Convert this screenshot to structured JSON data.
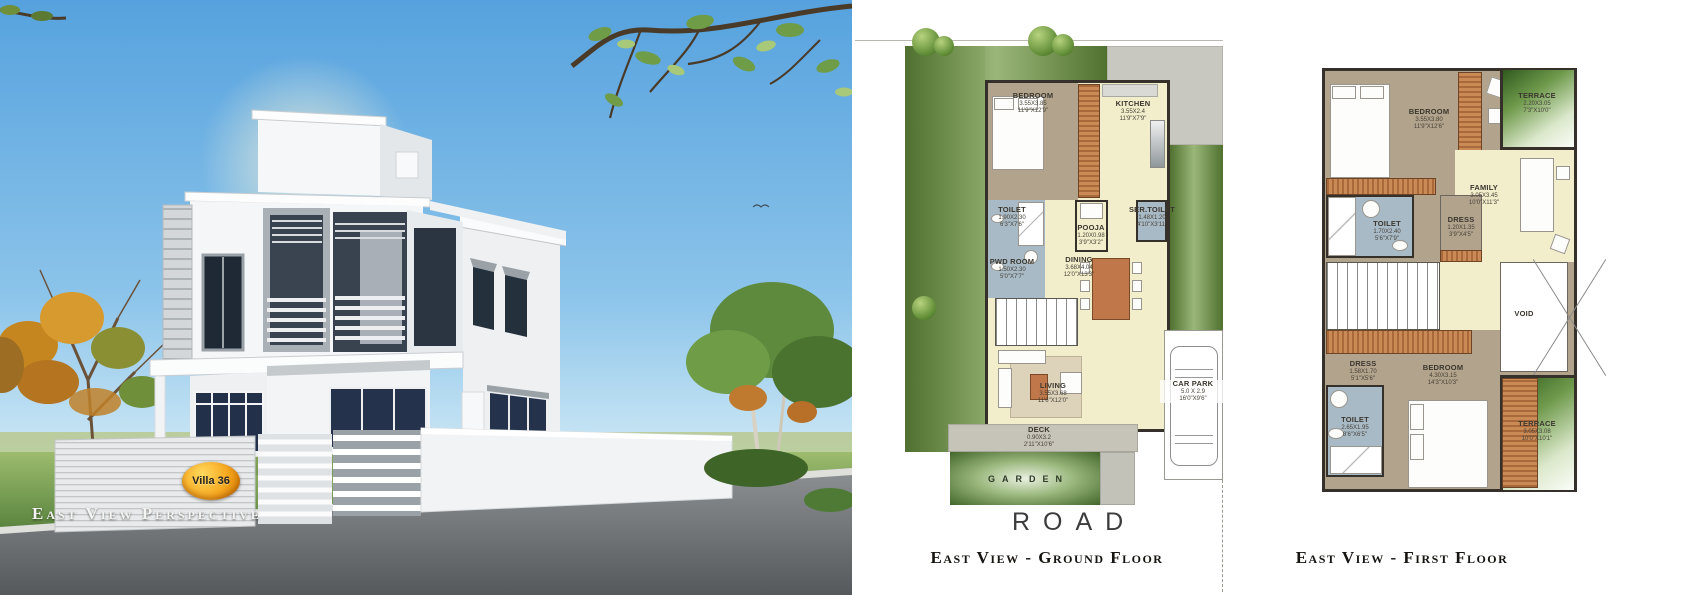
{
  "left_panel": {
    "caption": "East View Perspective",
    "villa_badge": "Villa 36"
  },
  "colors": {
    "sky_top": "#5fa8e0",
    "sky_bottom": "#cfe9f7",
    "grass": "#6f9c46",
    "road": "#6b6f72",
    "plan_bedroom_tan": "#b2a38c",
    "plan_living_yellow": "#f2eecb",
    "plan_toilet_blue": "#a9bac7",
    "plan_wood_orange": "#c0784a",
    "plan_wall_dark": "#35302a",
    "terrace_green": "#2f5a1e",
    "badge_orange": "#f7a81e"
  },
  "ground_floor": {
    "caption": "East View - Ground Floor",
    "garden_label": "GARDEN",
    "road_label": "ROAD",
    "rooms": {
      "bedroom": {
        "name": "BEDROOM",
        "m": "3.55X3.85",
        "ft": "11'9\"X12'9\""
      },
      "kitchen": {
        "name": "KITCHEN",
        "m": "3.55X2.4",
        "ft": "11'9\"X7'9\""
      },
      "toilet": {
        "name": "TOILET",
        "m": "1.90X2.30",
        "ft": "6'3\"X7'6\""
      },
      "pwd_room": {
        "name": "PWD ROOM",
        "m": "1.50X2.30",
        "ft": "5'0\"X7'7\""
      },
      "pooja": {
        "name": "POOJA",
        "m": "1.20X0.98",
        "ft": "3'9\"X3'2\""
      },
      "ser_toilet": {
        "name": "SER.TOILET",
        "m": "1.48X1.20",
        "ft": "4'10\"X3'11\""
      },
      "dining": {
        "name": "DINING",
        "m": "3.68X4.04",
        "ft": "12'0\"X13'3\""
      },
      "living": {
        "name": "LIVING",
        "m": "3.55X3.68",
        "ft": "11'6\"X12'0\""
      },
      "deck": {
        "name": "DECK",
        "m": "0.90X3.2",
        "ft": "2'11\"X10'6\""
      },
      "car_park": {
        "name": "CAR PARK",
        "m": "5.0 X 2.9",
        "ft": "16'0\"X9'6\""
      }
    }
  },
  "first_floor": {
    "caption": "East View - First Floor",
    "rooms": {
      "bedroom1": {
        "name": "BEDROOM",
        "m": "3.55X3.80",
        "ft": "11'9\"X12'6\""
      },
      "terrace1": {
        "name": "TERRACE",
        "m": "2.20X3.05",
        "ft": "7'3\"X10'0\""
      },
      "family": {
        "name": "FAMILY",
        "m": "3.05X3.45",
        "ft": "10'0\"X11'3\""
      },
      "dress1": {
        "name": "DRESS",
        "m": "1.20X1.35",
        "ft": "3'9\"X4'5\""
      },
      "toilet1": {
        "name": "TOILET",
        "m": "1.70X2.40",
        "ft": "5'6\"X7'9\""
      },
      "void": {
        "name": "VOID"
      },
      "dress2": {
        "name": "DRESS",
        "m": "1.58X1.70",
        "ft": "5'1\"X5'6\""
      },
      "bedroom2": {
        "name": "BEDROOM",
        "m": "4.30X3.15",
        "ft": "14'3\"X10'3\""
      },
      "toilet2": {
        "name": "TOILET",
        "m": "2.65X1.95",
        "ft": "8'6\"X6'5\""
      },
      "terrace2": {
        "name": "TERRACE",
        "m": "3.05X3.08",
        "ft": "10'0\"X10'1\""
      }
    }
  }
}
